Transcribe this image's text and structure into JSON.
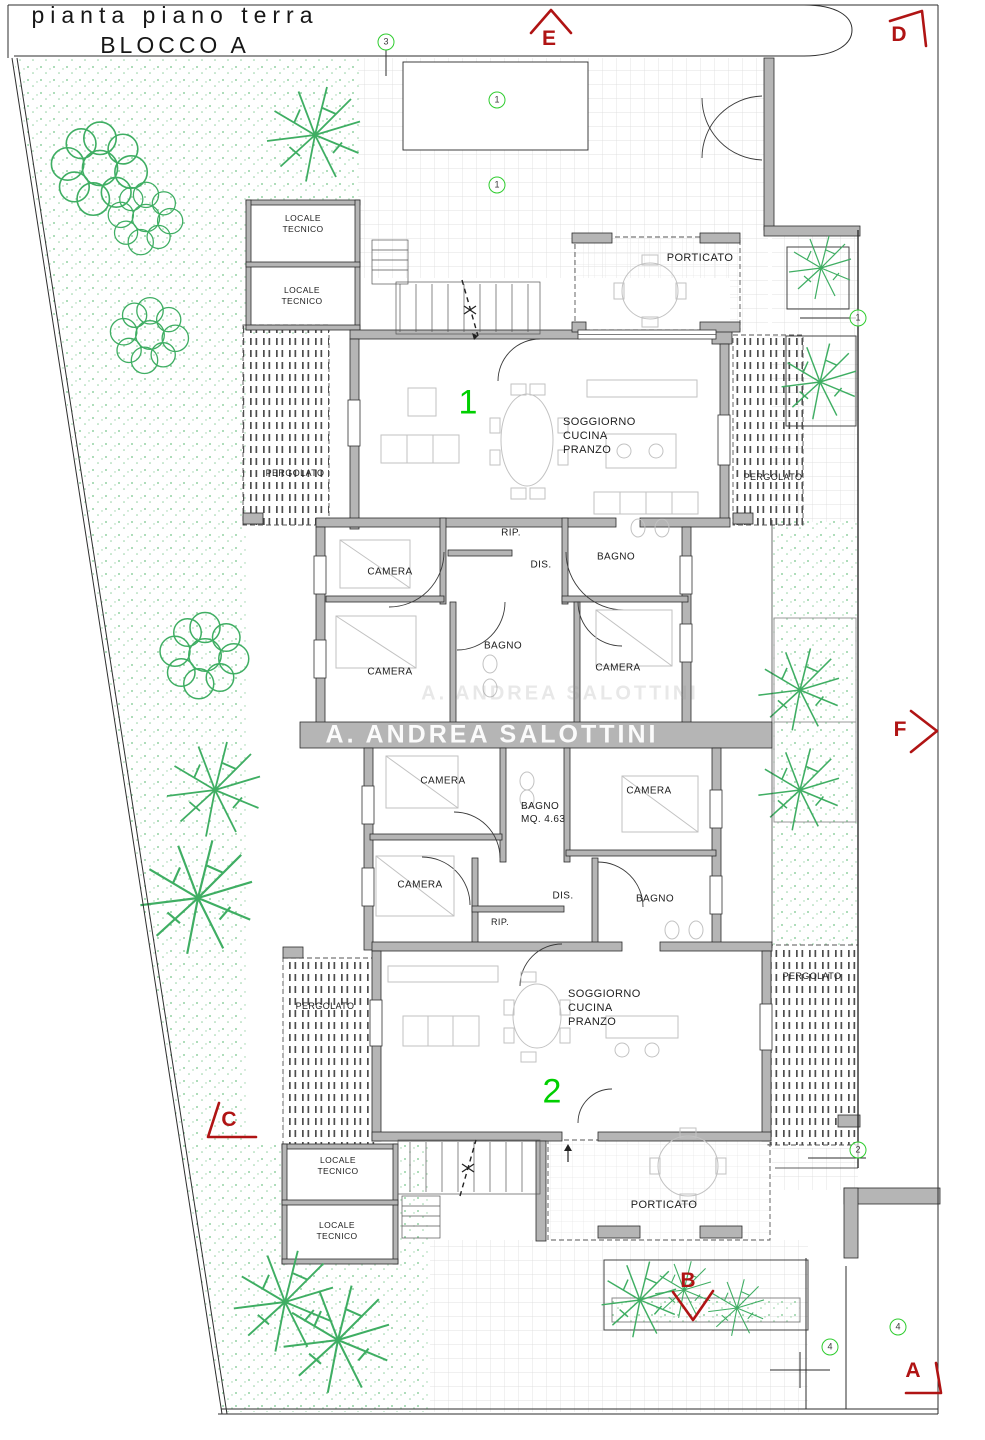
{
  "title": {
    "line1": "pianta piano terra",
    "line2": "BLOCCO A"
  },
  "watermark": {
    "text": "A.  ANDREA SALOTTINI"
  },
  "colors": {
    "marker_red": "#b01414",
    "unit_green": "#00cf00",
    "circle_green": "#2ecc2e",
    "wall_gray": "#b5b5b5"
  },
  "labels": [
    {
      "name": "room-label-locale-tecnico-1",
      "text": "LOCALE\nTECNICO",
      "x": 303,
      "y": 224,
      "size": 8.5
    },
    {
      "name": "room-label-locale-tecnico-2",
      "text": "LOCALE\nTECNICO",
      "x": 302,
      "y": 296,
      "size": 8.5
    },
    {
      "name": "room-label-porticato-top",
      "text": "PORTICATO",
      "x": 700,
      "y": 258,
      "size": 11
    },
    {
      "name": "room-label-soggiorno-1",
      "text": "SOGGIORNO\nCUCINA\nPRANZO",
      "x": 563,
      "y": 436,
      "size": 11,
      "align": "left"
    },
    {
      "name": "room-label-pergolato-1",
      "text": "PERGOLATO",
      "x": 295,
      "y": 474,
      "size": 9
    },
    {
      "name": "room-label-pergolato-2",
      "text": "PERGOLATO",
      "x": 773,
      "y": 478,
      "size": 9
    },
    {
      "name": "room-label-rip-1",
      "text": "RIP.",
      "x": 511,
      "y": 534,
      "size": 10
    },
    {
      "name": "room-label-dis-1",
      "text": "DIS.",
      "x": 541,
      "y": 566,
      "size": 10
    },
    {
      "name": "room-label-camera-1a",
      "text": "CAMERA",
      "x": 390,
      "y": 573,
      "size": 10
    },
    {
      "name": "room-label-bagno-1a",
      "text": "BAGNO",
      "x": 616,
      "y": 558,
      "size": 10
    },
    {
      "name": "room-label-bagno-1b",
      "text": "BAGNO",
      "x": 503,
      "y": 647,
      "size": 10
    },
    {
      "name": "room-label-camera-1b",
      "text": "CAMERA",
      "x": 390,
      "y": 673,
      "size": 10
    },
    {
      "name": "room-label-camera-1c",
      "text": "CAMERA",
      "x": 618,
      "y": 669,
      "size": 10
    },
    {
      "name": "room-label-camera-2a",
      "text": "CAMERA",
      "x": 443,
      "y": 782,
      "size": 10
    },
    {
      "name": "room-label-camera-2b",
      "text": "CAMERA",
      "x": 649,
      "y": 792,
      "size": 10
    },
    {
      "name": "room-label-bagno-2a",
      "text": "BAGNO\nMQ. 4.63",
      "x": 521,
      "y": 814,
      "size": 10,
      "align": "left"
    },
    {
      "name": "room-label-camera-2c",
      "text": "CAMERA",
      "x": 420,
      "y": 886,
      "size": 10
    },
    {
      "name": "room-label-dis-2",
      "text": "DIS.",
      "x": 563,
      "y": 897,
      "size": 10
    },
    {
      "name": "room-label-bagno-2b",
      "text": "BAGNO",
      "x": 655,
      "y": 900,
      "size": 10
    },
    {
      "name": "room-label-rip-2",
      "text": "RIP.",
      "x": 500,
      "y": 923,
      "size": 9
    },
    {
      "name": "room-label-pergolato-3",
      "text": "PERGOLATO",
      "x": 325,
      "y": 1007,
      "size": 9
    },
    {
      "name": "room-label-pergolato-4",
      "text": "PERGOLATO",
      "x": 812,
      "y": 977,
      "size": 9
    },
    {
      "name": "room-label-soggiorno-2",
      "text": "SOGGIORNO\nCUCINA\nPRANZO",
      "x": 568,
      "y": 1008,
      "size": 11,
      "align": "left"
    },
    {
      "name": "room-label-porticato-bottom",
      "text": "PORTICATO",
      "x": 664,
      "y": 1205,
      "size": 11
    },
    {
      "name": "room-label-locale-tecnico-3",
      "text": "LOCALE\nTECNICO",
      "x": 338,
      "y": 1166,
      "size": 8.5
    },
    {
      "name": "room-label-locale-tecnico-4",
      "text": "LOCALE\nTECNICO",
      "x": 337,
      "y": 1231,
      "size": 8.5
    }
  ],
  "section_markers": [
    {
      "letter": "E",
      "x": 549,
      "y": 39
    },
    {
      "letter": "D",
      "x": 899,
      "y": 35
    },
    {
      "letter": "F",
      "x": 900,
      "y": 730
    },
    {
      "letter": "C",
      "x": 229,
      "y": 1120
    },
    {
      "letter": "B",
      "x": 688,
      "y": 1281
    },
    {
      "letter": "A",
      "x": 913,
      "y": 1371
    }
  ],
  "circled_numbers": [
    {
      "n": "3",
      "x": 386,
      "y": 42
    },
    {
      "n": "1",
      "x": 497,
      "y": 100
    },
    {
      "n": "1",
      "x": 497,
      "y": 185
    },
    {
      "n": "1",
      "x": 858,
      "y": 318
    },
    {
      "n": "2",
      "x": 858,
      "y": 1150
    },
    {
      "n": "4",
      "x": 898,
      "y": 1327
    },
    {
      "n": "4",
      "x": 830,
      "y": 1347
    }
  ],
  "unit_numbers": [
    {
      "n": "1",
      "x": 468,
      "y": 403
    },
    {
      "n": "2",
      "x": 552,
      "y": 1092
    }
  ]
}
